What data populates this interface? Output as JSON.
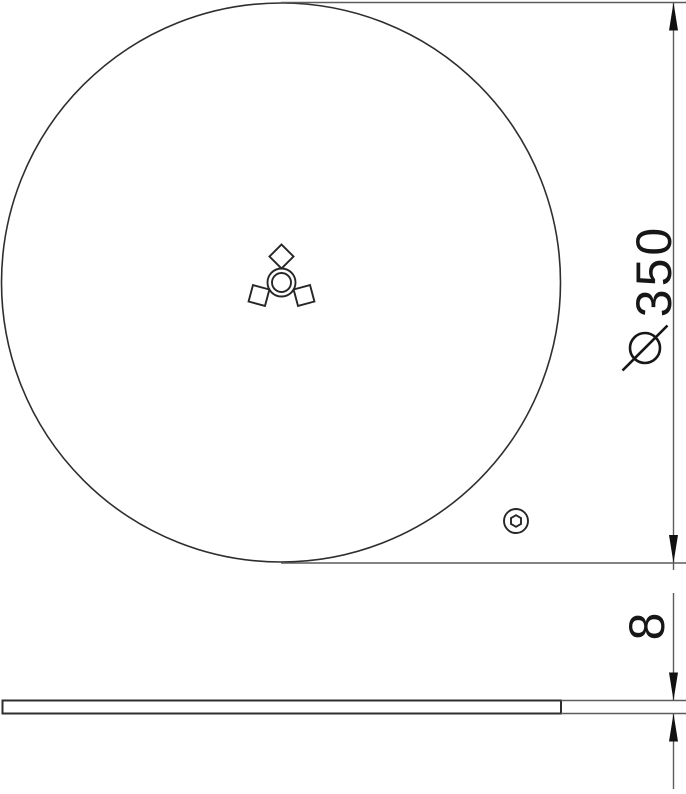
{
  "drawing": {
    "type": "technical-dimension-drawing",
    "part": "round cover plate",
    "plan_view": {
      "features": [
        "disc-outline",
        "center-hub-double-circle",
        "three-square-cutouts",
        "hex-socket-screw"
      ],
      "diameter_symbol": "⌀",
      "diameter_value": "350"
    },
    "side_view": {
      "features": [
        "thin-plate-profile"
      ],
      "thickness_value": "8"
    }
  },
  "colors": {
    "background": "#ffffff",
    "outline": "#2e2e2e",
    "dimension_line": "#5c5c5c",
    "arrow": "#111111",
    "text": "#161616"
  }
}
